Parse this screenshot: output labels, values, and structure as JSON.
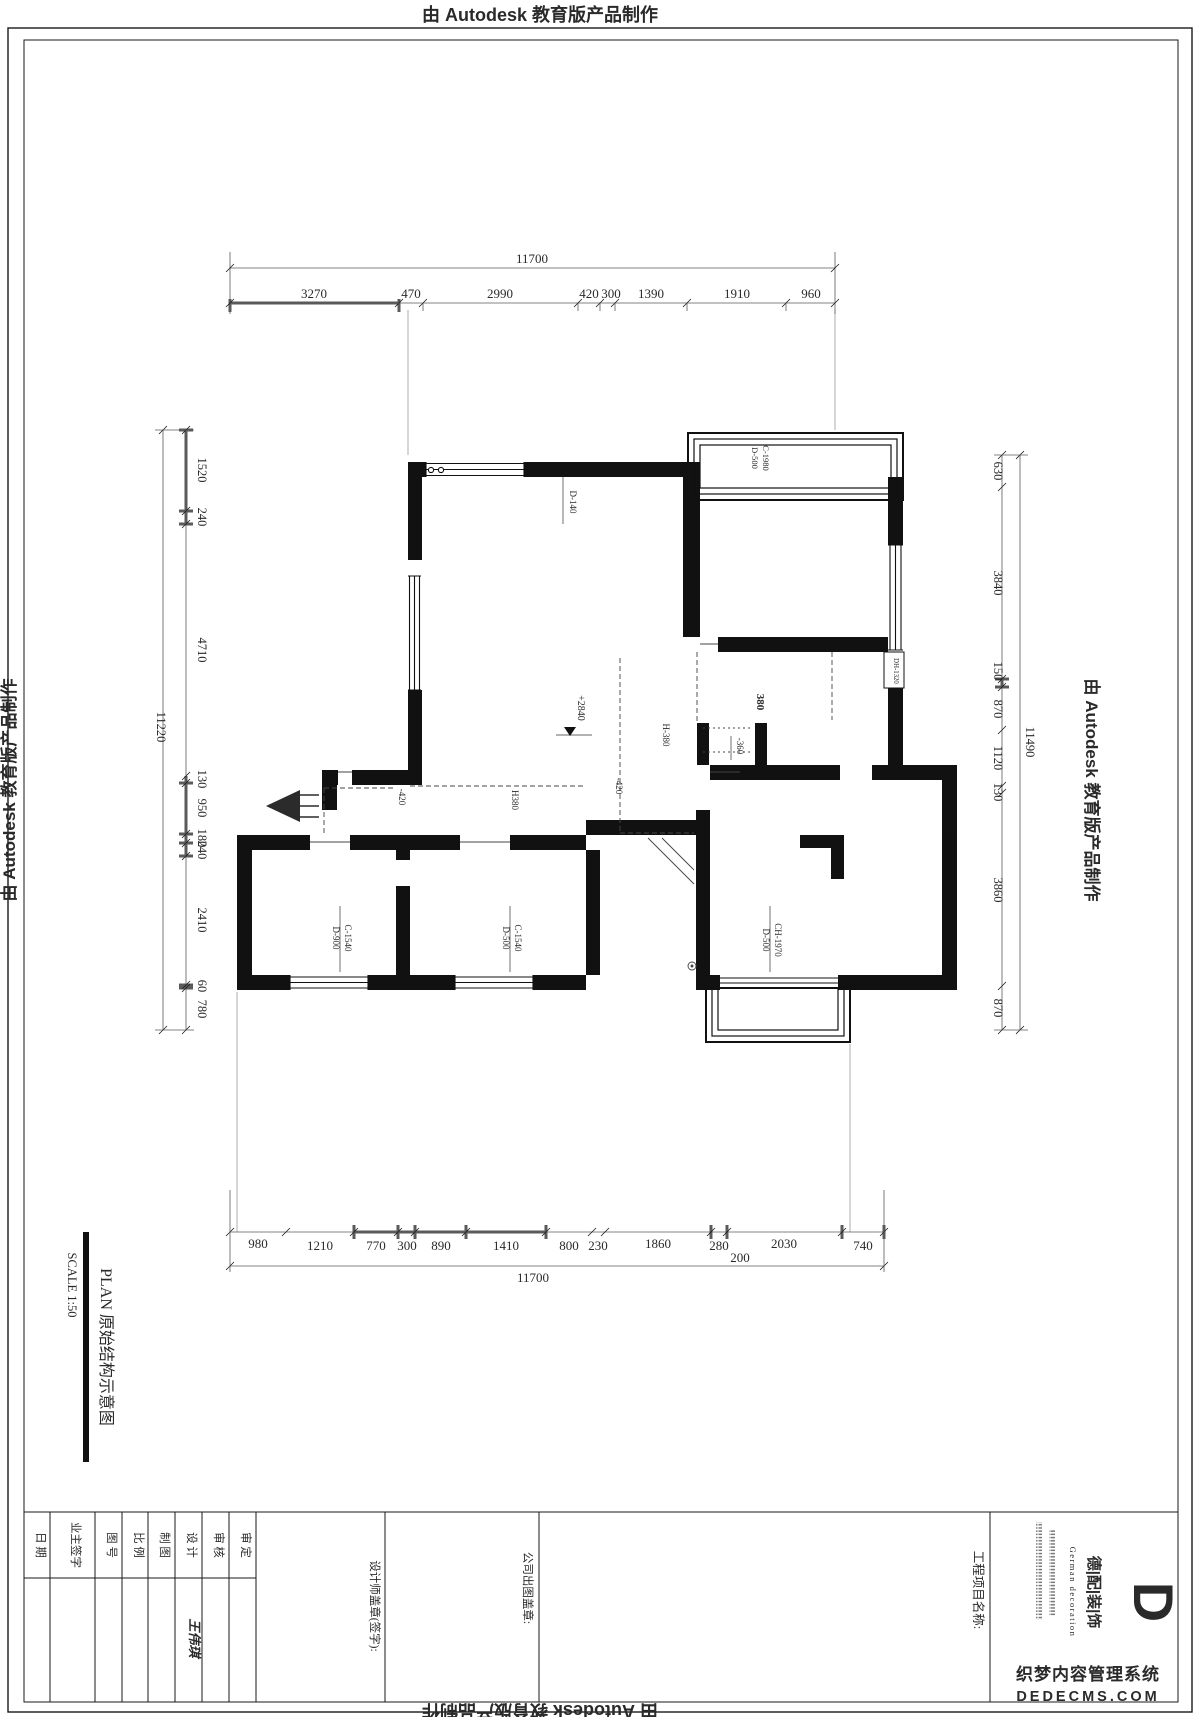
{
  "edge": {
    "top": "由 Autodesk 教育版产品制作",
    "left": "由 Autodesk 教育版产品制作",
    "right": "由 Autodesk 教育版产品制作",
    "bottom": "由 Autodesk 教育版产品制作"
  },
  "dims": {
    "top": {
      "overall": "11700",
      "segments": [
        "3270",
        "470",
        "2990",
        "420",
        "300",
        "1390",
        "1910",
        "960"
      ]
    },
    "bottom": {
      "overall": "11700",
      "sub": "200",
      "segments": [
        "980",
        "1210",
        "770",
        "300",
        "890",
        "1410",
        "800",
        "230",
        "1860",
        "280",
        "2030",
        "740"
      ]
    },
    "left": {
      "overall": "11220",
      "segments": [
        "1520",
        "240",
        "4710",
        "130",
        "950",
        "180",
        "240",
        "2410",
        "60",
        "780"
      ]
    },
    "right": {
      "overall": "11490",
      "segments": [
        "630",
        "3840",
        "150",
        "870",
        "1120",
        "130",
        "3860",
        "870"
      ]
    }
  },
  "plan_labels": {
    "win_top": "D-140",
    "bay_top_a": "D-500",
    "bay_top_b": "C-1980",
    "level": "+2840",
    "minus360": "-360",
    "dh": "DH-1320",
    "bold380": "380",
    "h380_a": "H-380",
    "h380_b": "H380",
    "minus420_a": "-420",
    "minus420_b": "-420",
    "win_bl_a": "D-900",
    "win_bl_b": "C-1540",
    "win_bm_a": "D-500",
    "win_bm_b": "C-1540",
    "win_br_a": "D-500",
    "win_br_b": "CH-1970"
  },
  "titleblock": {
    "plan_title": "PLAN  原始结构示意图",
    "scale": "SCALE  1:50",
    "fields": [
      "日 期",
      "业主签字",
      "图 号",
      "比 例",
      "制 图",
      "设 计",
      "审 核",
      "审 定"
    ],
    "designer_name": "王伟琪",
    "designer_stamp": "设计师盖章(签字):",
    "company_stamp": "公司出图盖章:",
    "project_name": "工程项目名称:",
    "logo_cn": "德|配|装|饰",
    "logo_en": "German decoration",
    "logo_mark": "D"
  },
  "watermark": {
    "line1": "织梦内容管理系统",
    "line2": "DEDECMS.COM"
  },
  "colors": {
    "ink": "#1a1a1a",
    "dimline": "#5a5a5a",
    "watermark": "#6e6e6e"
  }
}
